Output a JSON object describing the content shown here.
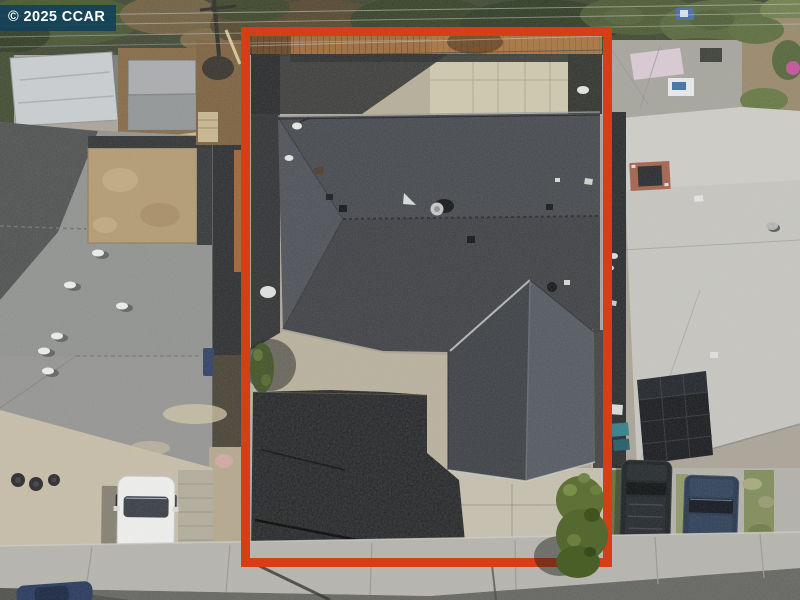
{
  "watermark": {
    "text": "© 2025 CCAR"
  },
  "colors": {
    "boundary_outline": "#d43f16",
    "watermark_background": "#124258",
    "watermark_text": "#ffffff",
    "main_roof": "#43464b",
    "left_neighbor_roof": "#8f918e",
    "right_neighbor_roof": "#c6c5c0",
    "black_mulch_yard": "#17181a",
    "concrete": "#b8b09b",
    "wood_fence": "#9c6a3a"
  }
}
